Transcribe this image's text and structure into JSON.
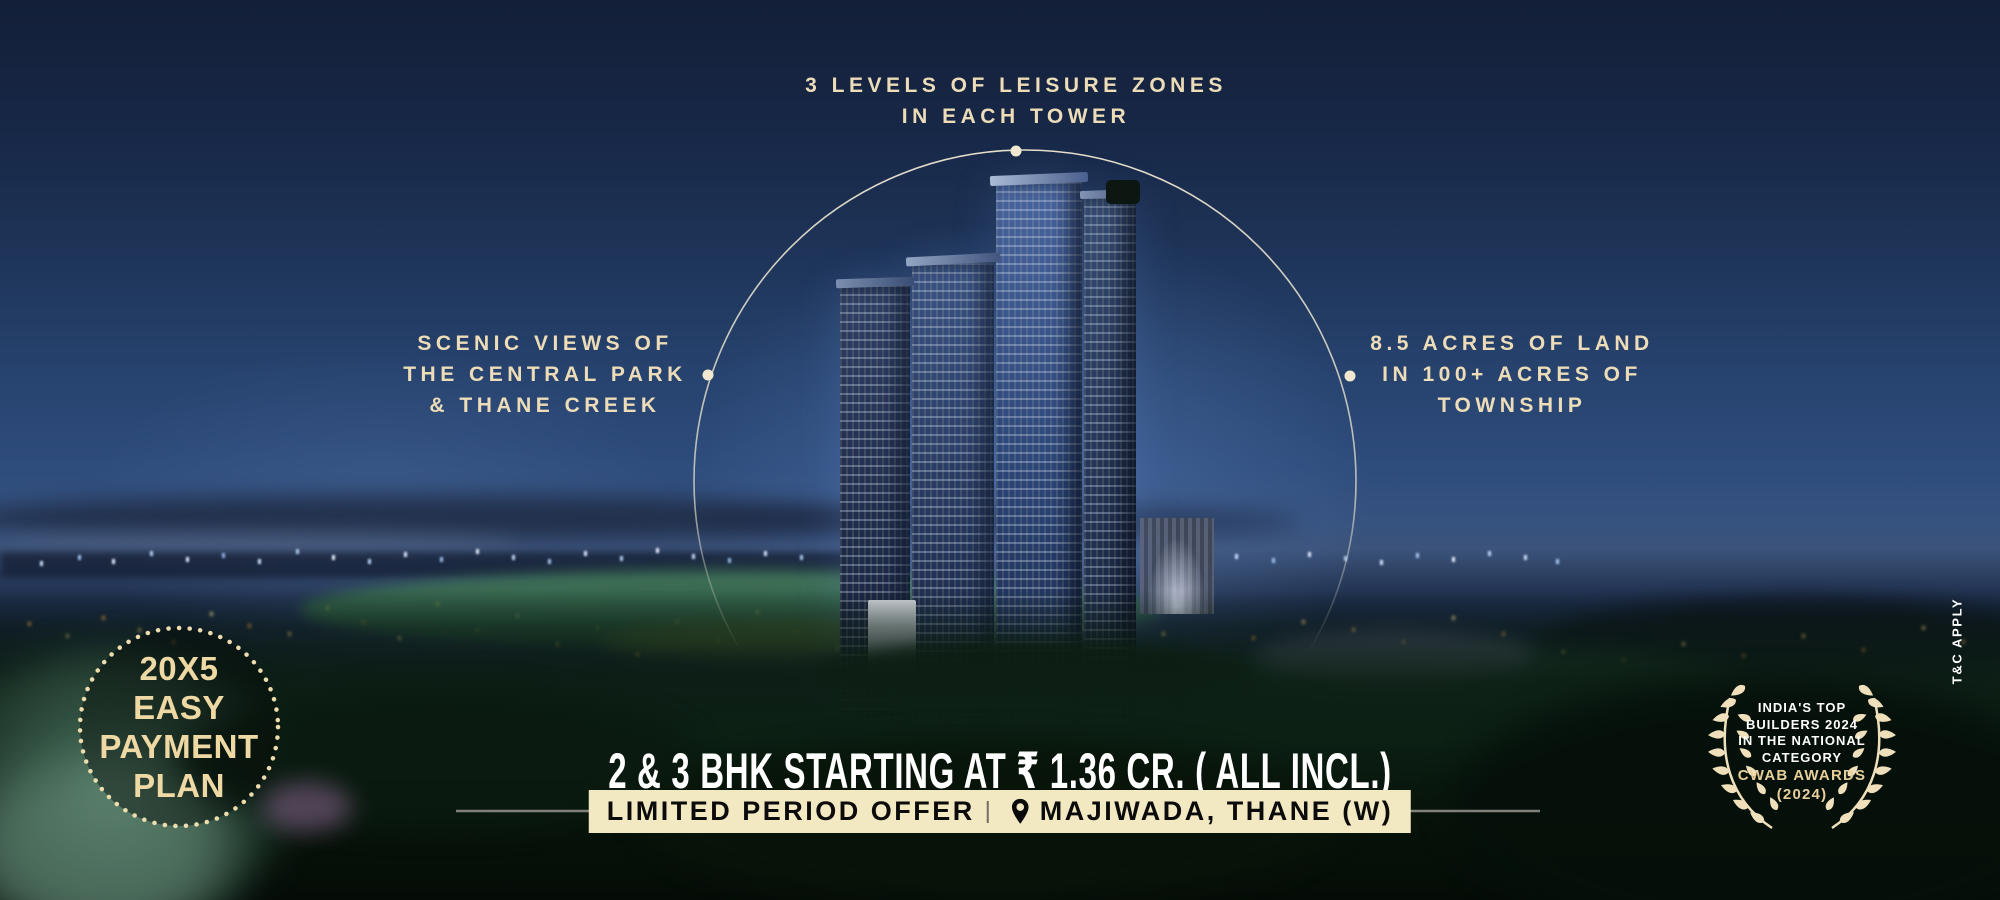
{
  "callouts": {
    "top": {
      "lines": [
        "3 LEVELS OF LEISURE ZONES",
        "IN EACH TOWER"
      ]
    },
    "left": {
      "lines": [
        "SCENIC VIEWS OF",
        "THE CENTRAL PARK",
        "& THANE CREEK"
      ]
    },
    "right": {
      "lines": [
        "8.5 ACRES OF LAND",
        "IN 100+ ACRES OF",
        "TOWNSHIP"
      ]
    }
  },
  "payment_badge": {
    "lines": [
      "20X5",
      "EASY",
      "PAYMENT",
      "PLAN"
    ]
  },
  "pricing": {
    "headline": "2 & 3 BHK STARTING AT ₹ 1.36 CR. ( ALL INCL.)"
  },
  "offer_bar": {
    "offer": "LIMITED PERIOD OFFER",
    "location": "MAJIWADA, THANE (W)"
  },
  "award_badge": {
    "lines": [
      "INDIA'S TOP",
      "BUILDERS 2024",
      "IN THE NATIONAL",
      "CATEGORY"
    ],
    "highlight_lines": [
      "CWAB AWARDS",
      "(2024)"
    ]
  },
  "disclaimer": "T&C APPLY",
  "colors": {
    "callout_cream": "#ecdcb8",
    "offer_bar_bg": "#f2e8c2",
    "badge_gold": "#eed9a4",
    "laurel_cream": "#efe0bb",
    "sky_top": "#131f38",
    "sky_mid": "#2e4c7c",
    "foliage_dark": "#0c2014"
  }
}
